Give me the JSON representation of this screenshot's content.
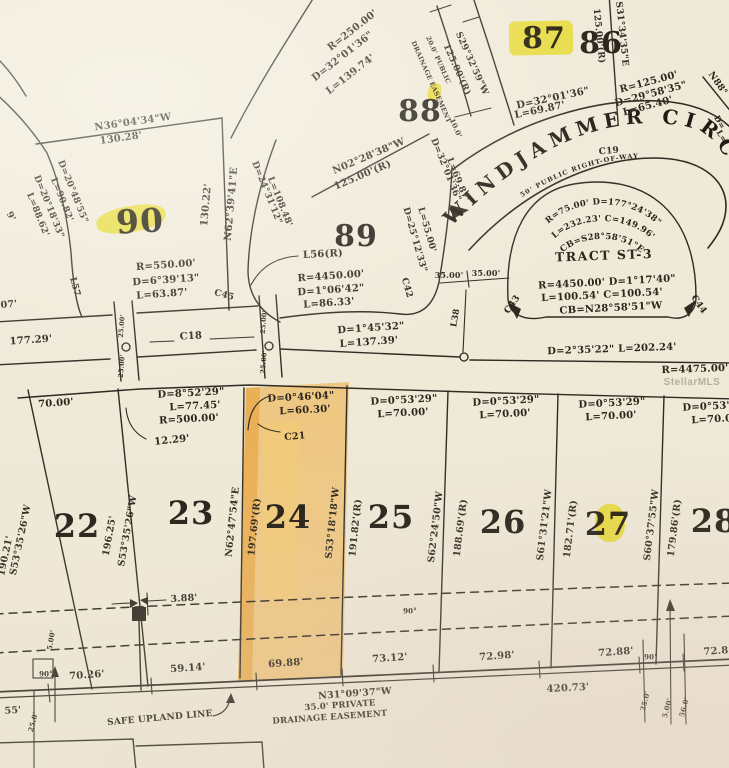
{
  "map": {
    "street": {
      "name": "WINDJAMMER CIRC",
      "right_of_way": "50' PUBLIC RIGHT-OF-WAY"
    },
    "tract": {
      "curve_top": [
        "R=75.00' D=177°24'38\"",
        "L=232.23' C=149.96'",
        "CB=S28°58'51\"E"
      ]
    },
    "watermark": "StellarMLS",
    "highlight_color": "#f6ee2c",
    "lot24_fill": "#eda52e",
    "labels": [
      {
        "n": "bearing-n36",
        "t": "N36°04'34\"W",
        "x": 133,
        "y": 123,
        "r": -8,
        "s": 10
      },
      {
        "n": "dist-130-28",
        "t": "130.28'",
        "x": 121,
        "y": 139,
        "r": -8,
        "s": 10
      },
      {
        "n": "curve-d20-48",
        "t": "D=20°48'55\"",
        "x": 72,
        "y": 192,
        "r": 68,
        "s": 9
      },
      {
        "n": "curve-l90-82",
        "t": "L=90.82'",
        "x": 61,
        "y": 200,
        "r": 68,
        "s": 9
      },
      {
        "n": "curve-d20-18",
        "t": "D=20°18'33\"",
        "x": 48,
        "y": 207,
        "r": 68,
        "s": 9
      },
      {
        "n": "curve-l88-62",
        "t": "L=88.62'",
        "x": 37,
        "y": 215,
        "r": 68,
        "s": 9
      },
      {
        "n": "partial-9",
        "t": "9'",
        "x": 10,
        "y": 217,
        "r": 60,
        "s": 9
      },
      {
        "n": "partial-07",
        "t": "07'",
        "x": 9,
        "y": 305,
        "r": -5,
        "s": 9.5
      },
      {
        "n": "label-l57",
        "t": "L57",
        "x": 74,
        "y": 287,
        "r": 75,
        "s": 9
      },
      {
        "n": "lot-90",
        "t": "90",
        "x": 140,
        "y": 221,
        "r": -3,
        "s": 33,
        "c": "lot"
      },
      {
        "n": "dist-130-22",
        "t": "130.22'",
        "x": 207,
        "y": 205,
        "r": -85,
        "s": 10
      },
      {
        "n": "bearing-n62-39",
        "t": "N62°39'41\"E",
        "x": 232,
        "y": 204,
        "r": -85,
        "s": 10
      },
      {
        "n": "curve-r550",
        "t": "R=550.00'",
        "x": 166,
        "y": 266,
        "r": -4,
        "s": 10
      },
      {
        "n": "curve-d6-39",
        "t": "D=6°39'13\"",
        "x": 166,
        "y": 281,
        "r": -4,
        "s": 10
      },
      {
        "n": "curve-l63-87",
        "t": "L=63.87'",
        "x": 162,
        "y": 295,
        "r": -4,
        "s": 10
      },
      {
        "n": "label-c45",
        "t": "C45",
        "x": 224,
        "y": 296,
        "r": 15,
        "s": 9
      },
      {
        "n": "curve-r250",
        "t": "R=250.00'",
        "x": 353,
        "y": 31,
        "r": -38,
        "s": 10
      },
      {
        "n": "curve-d32-01-a",
        "t": "D=32°01'36\"",
        "x": 343,
        "y": 57,
        "r": -38,
        "s": 10
      },
      {
        "n": "curve-l139",
        "t": "L=139.74'",
        "x": 351,
        "y": 75,
        "r": -38,
        "s": 10
      },
      {
        "n": "lot-88",
        "t": "88",
        "x": 420,
        "y": 112,
        "r": 0,
        "s": 30,
        "c": "lot"
      },
      {
        "n": "bearing-n02",
        "t": "N02°28'38\"W",
        "x": 369,
        "y": 157,
        "r": -23,
        "s": 10
      },
      {
        "n": "dist-125-r-a",
        "t": "125.00'(R)",
        "x": 363,
        "y": 176,
        "r": -23,
        "s": 10
      },
      {
        "n": "curve-d24-31",
        "t": "D=24°31'12\"",
        "x": 266,
        "y": 193,
        "r": 68,
        "s": 9
      },
      {
        "n": "curve-l108",
        "t": "L=108.48'",
        "x": 279,
        "y": 202,
        "r": 68,
        "s": 9
      },
      {
        "n": "lot-89",
        "t": "89",
        "x": 356,
        "y": 237,
        "r": 0,
        "s": 30,
        "c": "lot"
      },
      {
        "n": "label-l56",
        "t": "L56(R)",
        "x": 323,
        "y": 255,
        "r": -3,
        "s": 10
      },
      {
        "n": "curve-r4450",
        "t": "R=4450.00'",
        "x": 331,
        "y": 277,
        "r": -4,
        "s": 10
      },
      {
        "n": "curve-d1-06",
        "t": "D=1°06'42\"",
        "x": 331,
        "y": 291,
        "r": -4,
        "s": 10
      },
      {
        "n": "curve-l86-33",
        "t": "L=86.33'",
        "x": 329,
        "y": 304,
        "r": -4,
        "s": 10
      },
      {
        "n": "curve-d25-12",
        "t": "D=25°12'33\"",
        "x": 414,
        "y": 240,
        "r": 74,
        "s": 9
      },
      {
        "n": "curve-l55",
        "t": "L=55.00'",
        "x": 426,
        "y": 230,
        "r": 74,
        "s": 9
      },
      {
        "n": "label-c42",
        "t": "C42",
        "x": 406,
        "y": 288,
        "r": 74,
        "s": 9
      },
      {
        "n": "dist-35-a",
        "t": "35.00'",
        "x": 449,
        "y": 275,
        "r": 0,
        "s": 8
      },
      {
        "n": "dist-35-b",
        "t": "35.00'",
        "x": 486,
        "y": 273,
        "r": 0,
        "s": 8
      },
      {
        "n": "label-l38",
        "t": "L38",
        "x": 456,
        "y": 318,
        "r": -80,
        "s": 8.5
      },
      {
        "n": "bearing-s29",
        "t": "S29°32'59\"W",
        "x": 471,
        "y": 64,
        "r": 66,
        "s": 9
      },
      {
        "n": "dist-125-r-b",
        "t": "125.00'(R)",
        "x": 456,
        "y": 70,
        "r": 66,
        "s": 9
      },
      {
        "n": "ease-20-public",
        "t": "20.0' PUBLIC",
        "x": 438,
        "y": 60,
        "r": 66,
        "s": 6.5
      },
      {
        "n": "ease-drainage",
        "t": "DRAINAGE EASEMENT",
        "x": 431,
        "y": 82,
        "r": 66,
        "s": 6.5
      },
      {
        "n": "dist-10-0",
        "t": "10.0'",
        "x": 456,
        "y": 128,
        "r": 66,
        "s": 7
      },
      {
        "n": "curve-d32-01-b",
        "t": "D=32°01'36\"",
        "x": 445,
        "y": 170,
        "r": 68,
        "s": 9
      },
      {
        "n": "curve-l69-b",
        "t": "L=69.87'",
        "x": 457,
        "y": 180,
        "r": 68,
        "s": 9
      },
      {
        "n": "lot-87",
        "t": "87",
        "x": 544,
        "y": 39,
        "r": 0,
        "s": 30,
        "c": "lot"
      },
      {
        "n": "lot-86",
        "t": "86",
        "x": 601,
        "y": 44,
        "r": 0,
        "s": 30,
        "c": "lot"
      },
      {
        "n": "curve-d32-01-c",
        "t": "D=32°01'36\"",
        "x": 553,
        "y": 99,
        "r": -12,
        "s": 10
      },
      {
        "n": "curve-l69-87",
        "t": "L=69.87'",
        "x": 540,
        "y": 111,
        "r": -12,
        "s": 10
      },
      {
        "n": "dist-125-r-c",
        "t": "125.00'(R)",
        "x": 598,
        "y": 36,
        "r": 84,
        "s": 9
      },
      {
        "n": "bearing-s31-34",
        "t": "S31°34'35\"E",
        "x": 621,
        "y": 34,
        "r": 84,
        "s": 9
      },
      {
        "n": "curve-r125",
        "t": "R=125.00'",
        "x": 649,
        "y": 83,
        "r": -15,
        "s": 10
      },
      {
        "n": "curve-d29-58",
        "t": "D=29°58'35\"",
        "x": 651,
        "y": 95,
        "r": -15,
        "s": 10
      },
      {
        "n": "curve-l65-40",
        "t": "L=65.40'",
        "x": 648,
        "y": 107,
        "r": -15,
        "s": 10
      },
      {
        "n": "bearing-n88",
        "t": "N88°",
        "x": 717,
        "y": 84,
        "r": 55,
        "s": 9
      },
      {
        "n": "partial-d",
        "t": "D=",
        "x": 720,
        "y": 122,
        "r": 60,
        "s": 8
      },
      {
        "n": "partial-l",
        "t": "L=",
        "x": 722,
        "y": 136,
        "r": 60,
        "s": 8
      },
      {
        "n": "label-c19",
        "t": "C19",
        "x": 609,
        "y": 152,
        "r": -5,
        "s": 9
      },
      {
        "n": "tract-name",
        "t": "TRACT ST-3",
        "x": 604,
        "y": 256,
        "r": -2,
        "s": 12.5,
        "c": "tract"
      },
      {
        "n": "tract-r4450",
        "t": "R=4450.00' D=1°17'40\"",
        "x": 607,
        "y": 283,
        "r": -3,
        "s": 10
      },
      {
        "n": "tract-l100",
        "t": "L=100.54' C=100.54'",
        "x": 602,
        "y": 296,
        "r": -3,
        "s": 10
      },
      {
        "n": "tract-cb",
        "t": "CB=N28°58'51\"W",
        "x": 611,
        "y": 309,
        "r": -3,
        "s": 10
      },
      {
        "n": "label-c43",
        "t": "C43",
        "x": 513,
        "y": 305,
        "r": -55,
        "s": 9
      },
      {
        "n": "label-c44",
        "t": "C44",
        "x": 698,
        "y": 305,
        "r": 55,
        "s": 9
      },
      {
        "n": "dist-177-29",
        "t": "177.29'",
        "x": 31,
        "y": 341,
        "r": -4,
        "s": 10
      },
      {
        "n": "label-c18",
        "t": "C18",
        "x": 191,
        "y": 337,
        "r": -3,
        "s": 10
      },
      {
        "n": "dist-25-a",
        "t": "25.00'",
        "x": 122,
        "y": 326,
        "r": -85,
        "s": 6.5
      },
      {
        "n": "dist-25-b",
        "t": "25.00'",
        "x": 122,
        "y": 366,
        "r": -85,
        "s": 6.5
      },
      {
        "n": "dist-25-c",
        "t": "25.00'",
        "x": 264,
        "y": 322,
        "r": -85,
        "s": 6.5
      },
      {
        "n": "dist-25-d",
        "t": "25.00'",
        "x": 264,
        "y": 362,
        "r": -85,
        "s": 6.5
      },
      {
        "n": "curve-d1-45",
        "t": "D=1°45'32\"",
        "x": 371,
        "y": 329,
        "r": -4,
        "s": 10
      },
      {
        "n": "curve-l137",
        "t": "L=137.39'",
        "x": 369,
        "y": 343,
        "r": -4,
        "s": 10
      },
      {
        "n": "curve-d2-35",
        "t": "D=2°35'22\" L=202.24'",
        "x": 612,
        "y": 350,
        "r": -2,
        "s": 10
      },
      {
        "n": "curve-r4475",
        "t": "R=4475.00'",
        "x": 695,
        "y": 370,
        "r": -2,
        "s": 10
      },
      {
        "n": "watermark",
        "t": "StellarMLS",
        "x": 692,
        "y": 383,
        "r": 0,
        "s": 10,
        "c": "wm"
      },
      {
        "n": "dist-70-00",
        "t": "70.00'",
        "x": 56,
        "y": 404,
        "r": -4,
        "s": 10
      },
      {
        "n": "dist-12-29",
        "t": "12.29'",
        "x": 172,
        "y": 441,
        "r": -6,
        "s": 10
      },
      {
        "n": "curve-d8-52",
        "t": "D=8°52'29\"",
        "x": 191,
        "y": 394,
        "r": -3,
        "s": 10
      },
      {
        "n": "curve-l77-45",
        "t": "L=77.45'",
        "x": 195,
        "y": 407,
        "r": -3,
        "s": 10
      },
      {
        "n": "curve-r500",
        "t": "R=500.00'",
        "x": 189,
        "y": 420,
        "r": -3,
        "s": 10
      },
      {
        "n": "curve-d0-46",
        "t": "D=0°46'04\"",
        "x": 301,
        "y": 398,
        "r": -3,
        "s": 10
      },
      {
        "n": "curve-l60-30",
        "t": "L=60.30'",
        "x": 305,
        "y": 411,
        "r": -3,
        "s": 10
      },
      {
        "n": "label-c21",
        "t": "C21",
        "x": 295,
        "y": 437,
        "r": -5,
        "s": 9.5
      },
      {
        "n": "curve-d0-53-a",
        "t": "D=0°53'29\"",
        "x": 404,
        "y": 401,
        "r": -3,
        "s": 10
      },
      {
        "n": "curve-l70-a",
        "t": "L=70.00'",
        "x": 403,
        "y": 414,
        "r": -3,
        "s": 10
      },
      {
        "n": "curve-d0-53-b",
        "t": "D=0°53'29\"",
        "x": 506,
        "y": 402,
        "r": -3,
        "s": 10
      },
      {
        "n": "curve-l70-b",
        "t": "L=70.00'",
        "x": 505,
        "y": 415,
        "r": -3,
        "s": 10
      },
      {
        "n": "curve-d0-53-c",
        "t": "D=0°53'29\"",
        "x": 612,
        "y": 404,
        "r": -3,
        "s": 10
      },
      {
        "n": "curve-l70-c",
        "t": "L=70.00'",
        "x": 611,
        "y": 417,
        "r": -3,
        "s": 10
      },
      {
        "n": "curve-d0-53-d",
        "t": "D=0°53'29\"",
        "x": 716,
        "y": 407,
        "r": -3,
        "s": 10
      },
      {
        "n": "curve-l70-d",
        "t": "L=70.00'",
        "x": 717,
        "y": 420,
        "r": -3,
        "s": 10
      },
      {
        "n": "bearing-s53-35-a",
        "t": "S53°35'26\"W",
        "x": 21,
        "y": 540,
        "r": -78,
        "s": 9.5
      },
      {
        "n": "dist-190-21",
        "t": "190.21'",
        "x": 6,
        "y": 556,
        "r": -78,
        "s": 9.5
      },
      {
        "n": "dist-196-25",
        "t": "196.25'",
        "x": 110,
        "y": 536,
        "r": -80,
        "s": 9.5
      },
      {
        "n": "bearing-s53-35-b",
        "t": "S53°35'26\"W",
        "x": 128,
        "y": 531,
        "r": -80,
        "s": 9.5
      },
      {
        "n": "lot-22",
        "t": "22",
        "x": 77,
        "y": 526,
        "r": 0,
        "s": 32,
        "c": "lot"
      },
      {
        "n": "lot-23",
        "t": "23",
        "x": 191,
        "y": 513,
        "r": 0,
        "s": 32,
        "c": "lot"
      },
      {
        "n": "bearing-n62-47",
        "t": "N62°47'54\"E",
        "x": 233,
        "y": 522,
        "r": -84,
        "s": 9.5
      },
      {
        "n": "dist-197-69",
        "t": "197.69'(R)",
        "x": 255,
        "y": 527,
        "r": -84,
        "s": 9.5
      },
      {
        "n": "lot-24",
        "t": "24",
        "x": 288,
        "y": 517,
        "r": 0,
        "s": 32,
        "c": "lot"
      },
      {
        "n": "bearing-s53-18",
        "t": "S53°18'18\"W",
        "x": 333,
        "y": 523,
        "r": -84,
        "s": 9.5
      },
      {
        "n": "dist-191-82",
        "t": "191.82'(R)",
        "x": 356,
        "y": 528,
        "r": -84,
        "s": 9.5
      },
      {
        "n": "lot-25",
        "t": "25",
        "x": 391,
        "y": 517,
        "r": 0,
        "s": 32,
        "c": "lot"
      },
      {
        "n": "bearing-s62-24",
        "t": "S62°24'50\"W",
        "x": 436,
        "y": 527,
        "r": -83,
        "s": 9.5
      },
      {
        "n": "dist-188-69",
        "t": "188.69'(R)",
        "x": 461,
        "y": 528,
        "r": -83,
        "s": 9.5
      },
      {
        "n": "lot-26",
        "t": "26",
        "x": 503,
        "y": 522,
        "r": 0,
        "s": 32,
        "c": "lot"
      },
      {
        "n": "bearing-s61-31",
        "t": "S61°31'21\"W",
        "x": 545,
        "y": 525,
        "r": -83,
        "s": 9.5
      },
      {
        "n": "dist-182-71",
        "t": "182.71'(R)",
        "x": 571,
        "y": 529,
        "r": -83,
        "s": 9.5
      },
      {
        "n": "lot-27",
        "t": "27",
        "x": 608,
        "y": 524,
        "r": 0,
        "s": 32,
        "c": "lot"
      },
      {
        "n": "bearing-s60-37",
        "t": "S60°37'55\"W",
        "x": 652,
        "y": 525,
        "r": -83,
        "s": 9.5
      },
      {
        "n": "dist-179-86",
        "t": "179.86'(R)",
        "x": 675,
        "y": 528,
        "r": -83,
        "s": 9.5
      },
      {
        "n": "lot-28",
        "t": "28",
        "x": 714,
        "y": 521,
        "r": 0,
        "s": 32,
        "c": "lot"
      },
      {
        "n": "dist-3-88",
        "t": "3.88'",
        "x": 184,
        "y": 599,
        "r": -3,
        "s": 9.5
      },
      {
        "n": "angle-90-a",
        "t": "90°",
        "x": 410,
        "y": 611,
        "r": 0,
        "s": 7
      },
      {
        "n": "angle-90-b",
        "t": "90°",
        "x": 46,
        "y": 674,
        "r": 0,
        "s": 7
      },
      {
        "n": "angle-90-c",
        "t": "90°",
        "x": 651,
        "y": 657,
        "r": 0,
        "s": 7
      },
      {
        "n": "dist-70-26",
        "t": "70.26'",
        "x": 87,
        "y": 676,
        "r": -4,
        "s": 10
      },
      {
        "n": "dist-59-14",
        "t": "59.14'",
        "x": 188,
        "y": 669,
        "r": -4,
        "s": 10
      },
      {
        "n": "dist-69-88",
        "t": "69.88'",
        "x": 286,
        "y": 664,
        "r": -4,
        "s": 10
      },
      {
        "n": "dist-73-12",
        "t": "73.12'",
        "x": 390,
        "y": 659,
        "r": -4,
        "s": 10
      },
      {
        "n": "dist-72-98",
        "t": "72.98'",
        "x": 497,
        "y": 657,
        "r": -4,
        "s": 10
      },
      {
        "n": "dist-72-88",
        "t": "72.88'",
        "x": 616,
        "y": 653,
        "r": -4,
        "s": 10
      },
      {
        "n": "dist-72-8-partial",
        "t": "72.8",
        "x": 716,
        "y": 652,
        "r": -4,
        "s": 10
      },
      {
        "n": "dist-420-73",
        "t": "420.73'",
        "x": 568,
        "y": 689,
        "r": -3,
        "s": 10
      },
      {
        "n": "bearing-n31-09",
        "t": "N31°09'37\"W",
        "x": 355,
        "y": 694,
        "r": -4,
        "s": 9.5
      },
      {
        "n": "ease-35-private",
        "t": "35.0' PRIVATE",
        "x": 340,
        "y": 706,
        "r": -4,
        "s": 8.5
      },
      {
        "n": "ease-drainage-2",
        "t": "DRAINAGE EASEMENT",
        "x": 330,
        "y": 718,
        "r": -4,
        "s": 8.5
      },
      {
        "n": "safe-upland",
        "t": "SAFE UPLAND LINE",
        "x": 160,
        "y": 719,
        "r": -5,
        "s": 9
      },
      {
        "n": "dist-5-00-a",
        "t": "5.00'",
        "x": 51,
        "y": 640,
        "r": -80,
        "s": 7
      },
      {
        "n": "partial-55",
        "t": "55'",
        "x": 13,
        "y": 711,
        "r": -4,
        "s": 9.5
      },
      {
        "n": "dist-25-0-a",
        "t": "25.0'",
        "x": 33,
        "y": 722,
        "r": -75,
        "s": 7
      },
      {
        "n": "dist-25-0-b",
        "t": "25.0'",
        "x": 645,
        "y": 701,
        "r": -75,
        "s": 7
      },
      {
        "n": "dist-5-00-b",
        "t": "5.00'",
        "x": 667,
        "y": 708,
        "r": -75,
        "s": 7
      },
      {
        "n": "dist-56-0",
        "t": "56.0'",
        "x": 684,
        "y": 707,
        "r": -75,
        "s": 7
      }
    ]
  }
}
